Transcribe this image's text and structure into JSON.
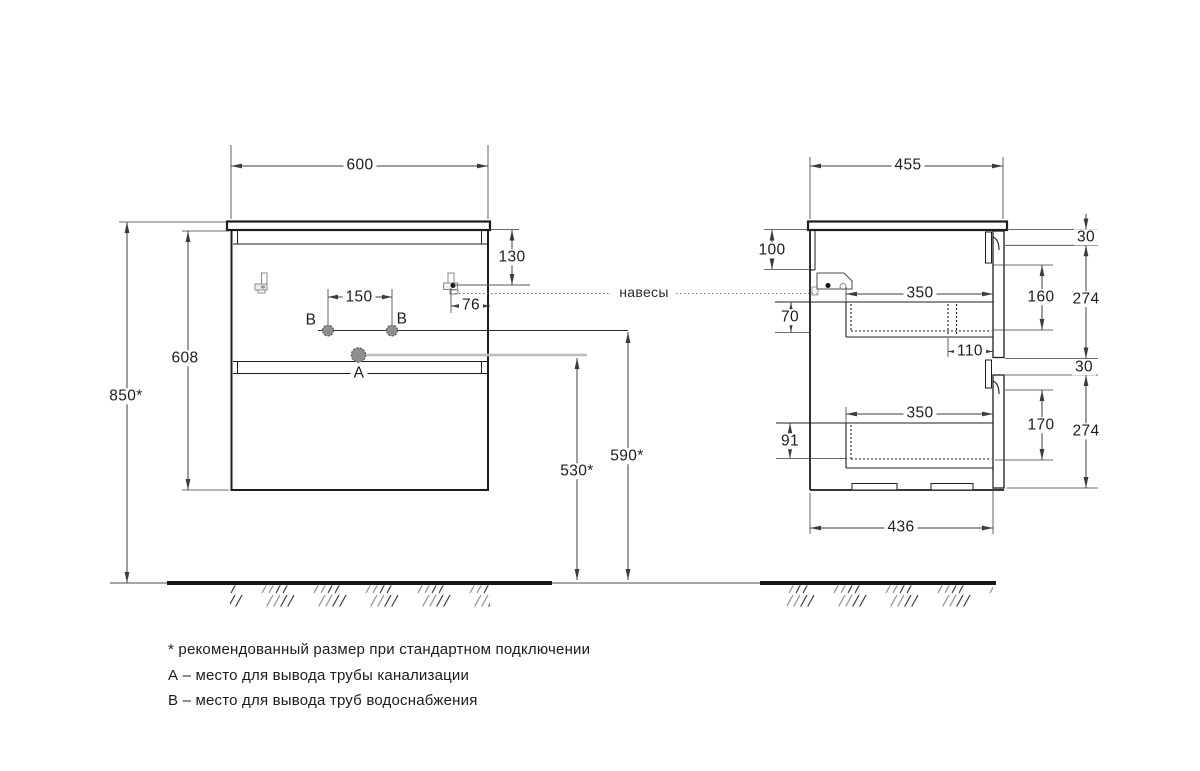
{
  "front_view": {
    "top_width": "600",
    "hanger_drop": "130",
    "hanger_side_offset": "76",
    "supply_spacing": "150",
    "body_height": "608",
    "top_height_from_floor": "850*",
    "drain_outlet_height": "530*",
    "supply_outlet_height": "590*",
    "drain_label": "А",
    "supply_label_left": "В",
    "supply_label_right": "В"
  },
  "side_view": {
    "top_depth": "455",
    "hanger_zone_height": "100",
    "drawer1_rim_drop": "70",
    "drawer1_depth": "350",
    "slide_clearance": "110",
    "front1_opening": "160",
    "front1_panel_height": "274",
    "front1_top_gap": "30",
    "drawer2_rim_drop": "91",
    "drawer2_depth": "350",
    "front2_opening": "170",
    "front2_panel_height": "274",
    "front2_top_gap": "30",
    "bottom_depth": "436"
  },
  "callouts": {
    "hangers": "навесы"
  },
  "notes": {
    "recommended": "* рекомендованный размер при стандартном подключении",
    "point_a": "А – место для вывода трубы канализации",
    "point_b": "В – место для вывода труб водоснабжения"
  },
  "colors": {
    "line": "#1d1d1b",
    "dim": "#3c3c3c",
    "gray_line": "#bdbdbd",
    "hole_fill": "#8f8f8f"
  }
}
